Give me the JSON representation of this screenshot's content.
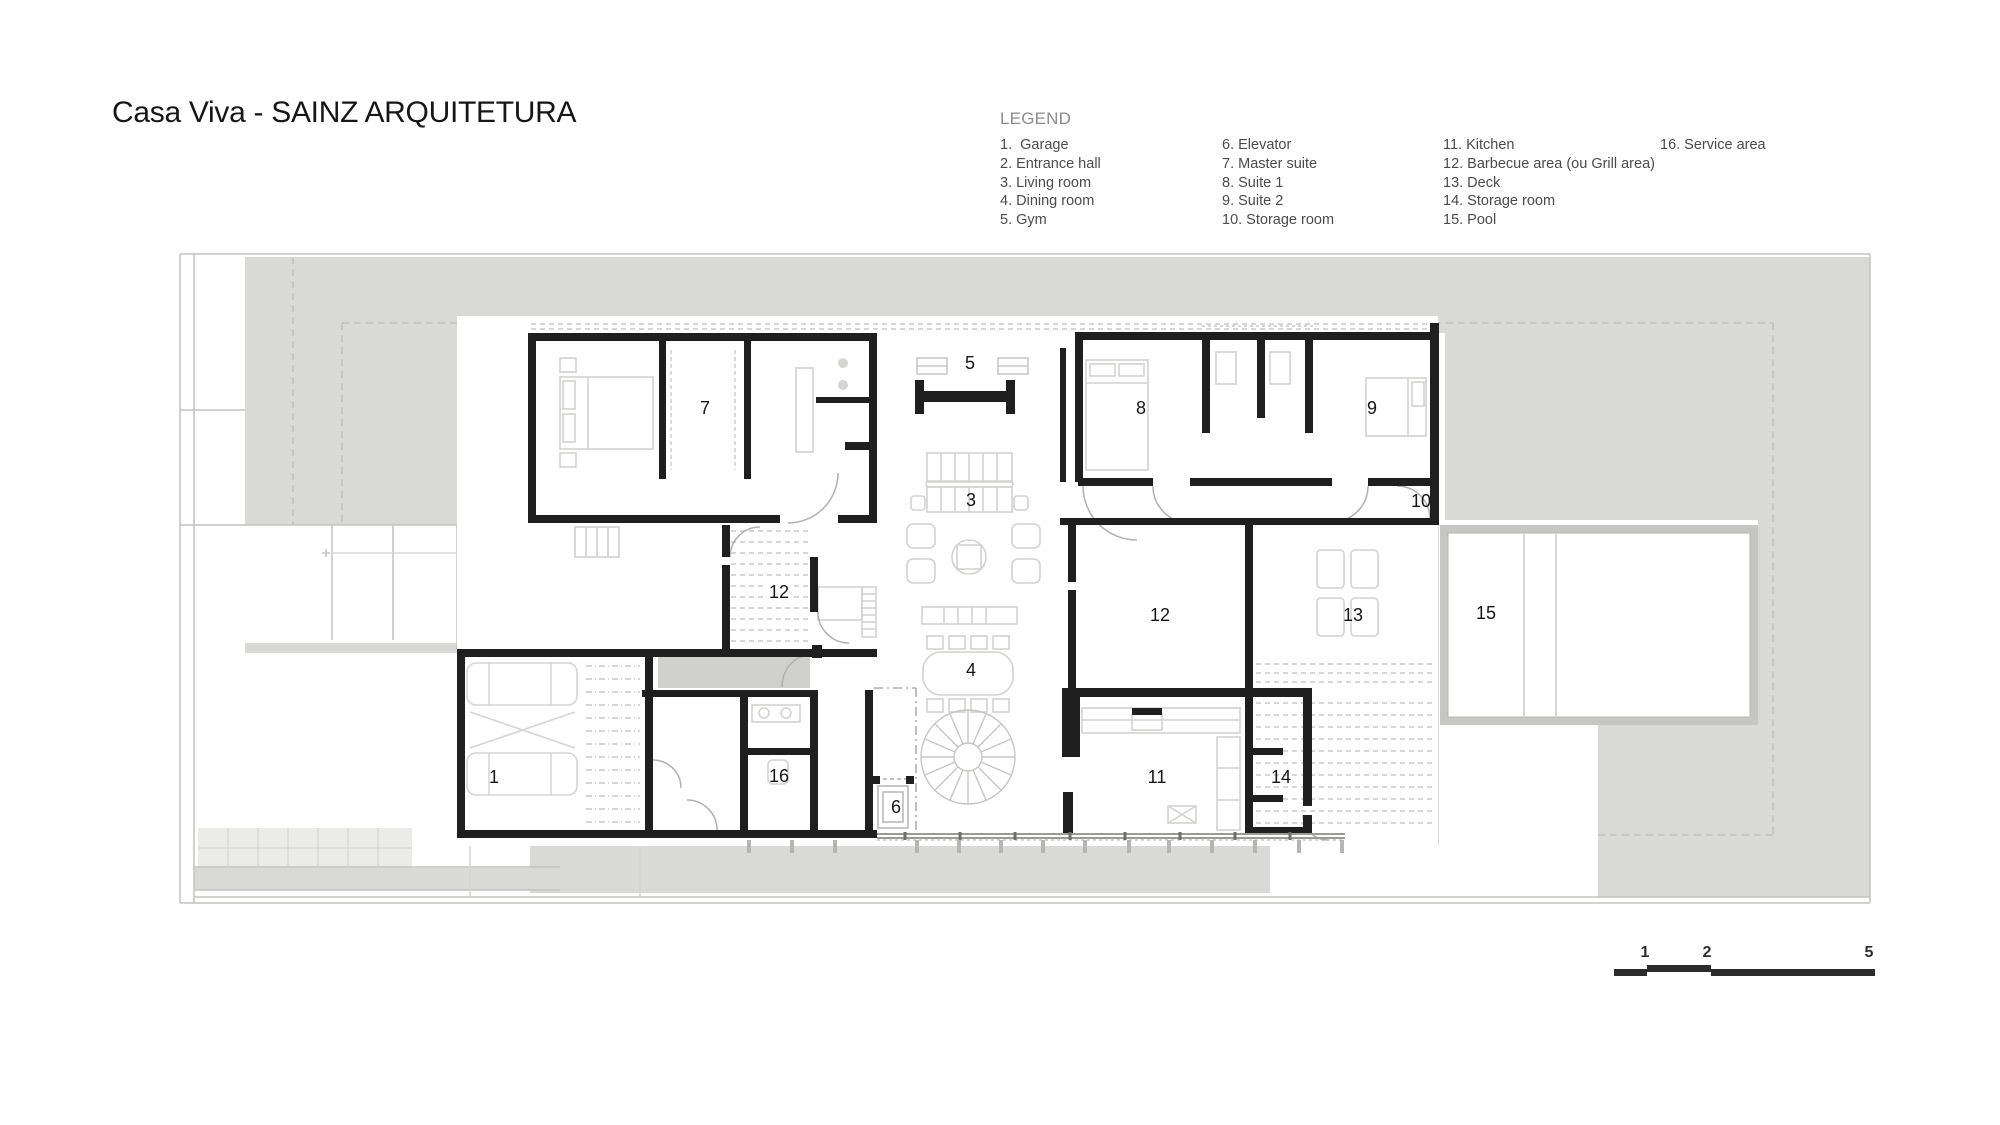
{
  "title": "Casa Viva - SAINZ ARQUITETURA",
  "legend": {
    "heading": "LEGEND",
    "columns": [
      {
        "items": [
          "1.  Garage",
          "2. Entrance hall",
          "3. Living room",
          "4. Dining room",
          "5. Gym"
        ]
      },
      {
        "items": [
          "6. Elevator",
          "7. Master suite",
          "8. Suite 1",
          "9. Suite 2",
          "10. Storage room"
        ]
      },
      {
        "items": [
          "11. Kitchen",
          "12. Barbecue area (ou Grill area)",
          "13. Deck",
          "14. Storage room",
          "15. Pool"
        ]
      },
      {
        "items": [
          "16. Service area"
        ]
      }
    ]
  },
  "plan": {
    "labels": [
      {
        "room": "garage",
        "text": "1"
      },
      {
        "room": "living-room",
        "text": "3"
      },
      {
        "room": "dining-room",
        "text": "4"
      },
      {
        "room": "gym",
        "text": "5"
      },
      {
        "room": "elevator",
        "text": "6"
      },
      {
        "room": "master-suite",
        "text": "7"
      },
      {
        "room": "suite-1",
        "text": "8"
      },
      {
        "room": "suite-2",
        "text": "9"
      },
      {
        "room": "storage-room-10",
        "text": "10"
      },
      {
        "room": "kitchen",
        "text": "11"
      },
      {
        "room": "barbecue-area",
        "text": "12"
      },
      {
        "room": "grill-area",
        "text": "12"
      },
      {
        "room": "deck",
        "text": "13"
      },
      {
        "room": "storage-room-14",
        "text": "14"
      },
      {
        "room": "pool",
        "text": "15"
      },
      {
        "room": "service-area",
        "text": "16"
      }
    ]
  },
  "scale_bar": {
    "labels": [
      "1",
      "2",
      "5"
    ]
  },
  "colors": {
    "wall": "#1f1f1f",
    "site_gray": "#d9d9d7",
    "vestibule_gray": "#d0d0ce",
    "line_gray": "#c2c2c0",
    "label": "#161616"
  }
}
